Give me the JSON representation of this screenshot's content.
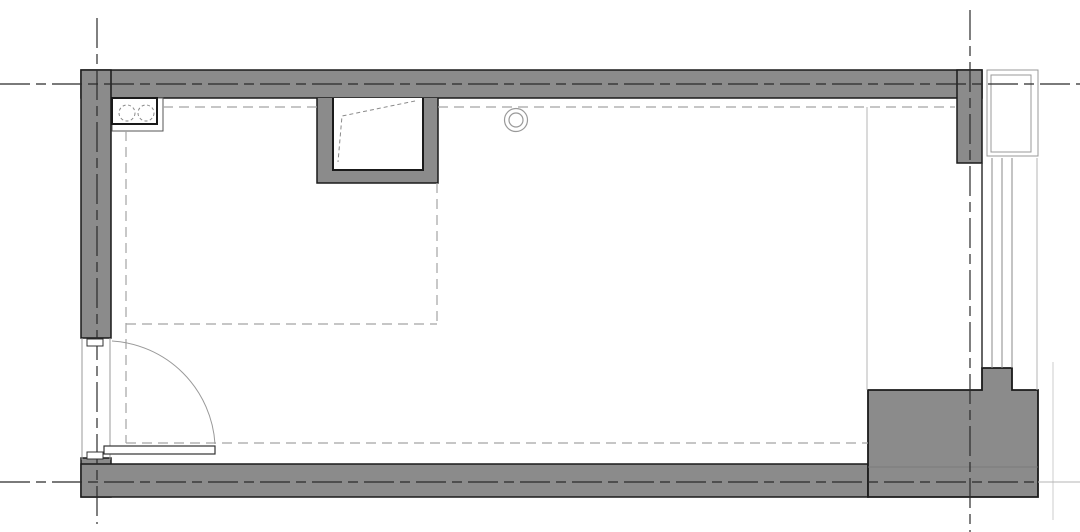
{
  "meta": {
    "description": "Architectural floor plan of a single rectangular room (CAD plan view), no text labels visible",
    "canvas": {
      "width": 1080,
      "height": 532
    }
  },
  "colors": {
    "background": "#ffffff",
    "wall_fill": "#8b8b8b",
    "wall_outline": "#1a1a1a",
    "centerline": "#2b2b2b",
    "hidden_line": "#a3a3a3",
    "light_line": "#b5b5b5",
    "faint_line": "#cccccc",
    "fixture_line": "#333333",
    "fixture_dashed": "#8a8a8a",
    "thin_gray": "#999999",
    "white": "#ffffff"
  },
  "elements": [
    {
      "name": "top-wall",
      "kind": "wall",
      "type": "rect",
      "x": 81,
      "y": 70,
      "w": 901,
      "h": 28,
      "fill": "wall_fill",
      "stroke": "wall_outline",
      "sw": 1.5
    },
    {
      "name": "left-wall",
      "kind": "wall",
      "type": "rect",
      "x": 81,
      "y": 70,
      "w": 30,
      "h": 268,
      "fill": "wall_fill",
      "stroke": "wall_outline",
      "sw": 1.5
    },
    {
      "name": "right-wall-stub",
      "kind": "wall",
      "type": "rect",
      "x": 957,
      "y": 70,
      "w": 25,
      "h": 93,
      "fill": "wall_fill",
      "stroke": "wall_outline",
      "sw": 1.5
    },
    {
      "name": "left-wall-bottom",
      "kind": "wall",
      "type": "rect",
      "x": 81,
      "y": 458,
      "w": 30,
      "h": 39,
      "fill": "wall_fill",
      "stroke": "wall_outline",
      "sw": 1.5
    },
    {
      "name": "bottom-wall",
      "kind": "wall",
      "type": "rect",
      "x": 81,
      "y": 464,
      "w": 787,
      "h": 33,
      "fill": "wall_fill",
      "stroke": "wall_outline",
      "sw": 1.5
    },
    {
      "name": "corner-pier",
      "kind": "wall",
      "type": "path",
      "d": "M868,390 L982,390 L982,368 L1012,368 L1012,390 L1038,390 L1038,497 L868,497 Z",
      "fill": "wall_fill",
      "stroke": "wall_outline",
      "sw": 1.8
    },
    {
      "name": "alcove-outer",
      "kind": "wall",
      "type": "path",
      "d": "M317,98 L317,183 L438,183 L438,98",
      "fill": "wall_fill",
      "stroke": "wall_outline",
      "sw": 1.5
    },
    {
      "name": "alcove-recess",
      "kind": "niche",
      "type": "path",
      "d": "M333,98 L333,170 L423,170 L423,98",
      "fill": "white",
      "stroke": "wall_outline",
      "sw": 2
    },
    {
      "name": "alcove-hidden-flap",
      "kind": "hidden",
      "type": "polyline",
      "pts": "415,101 342,116 338,162",
      "stroke": "fixture_dashed",
      "sw": 1,
      "dash": "4,3"
    },
    {
      "name": "pier-hidden-edge",
      "kind": "detail",
      "type": "line",
      "x1": 868,
      "y1": 467,
      "x2": 1038,
      "y2": 467,
      "stroke": "#767676",
      "sw": 0.8
    },
    {
      "name": "window-panel-outer",
      "kind": "window",
      "type": "rect",
      "x": 987,
      "y": 70,
      "w": 51,
      "h": 86,
      "fill": "white",
      "stroke": "thin_gray",
      "sw": 1
    },
    {
      "name": "window-panel-inner",
      "kind": "window",
      "type": "rect",
      "x": 991,
      "y": 75,
      "w": 40,
      "h": 77,
      "fill": "none",
      "stroke": "thin_gray",
      "sw": 1
    },
    {
      "name": "window-jamb-line",
      "kind": "window",
      "type": "line",
      "x1": 982,
      "y1": 163,
      "x2": 982,
      "y2": 368,
      "stroke": "fixture_line",
      "sw": 1.5
    },
    {
      "name": "window-glazing-1",
      "kind": "window",
      "type": "line",
      "x1": 992,
      "y1": 158,
      "x2": 992,
      "y2": 368,
      "stroke": "fixture_dashed",
      "sw": 1
    },
    {
      "name": "window-glazing-2",
      "kind": "window",
      "type": "line",
      "x1": 1002,
      "y1": 158,
      "x2": 1002,
      "y2": 368,
      "stroke": "fixture_dashed",
      "sw": 1
    },
    {
      "name": "window-glazing-3",
      "kind": "window",
      "type": "line",
      "x1": 1012,
      "y1": 158,
      "x2": 1012,
      "y2": 368,
      "stroke": "fixture_dashed",
      "sw": 1
    },
    {
      "name": "window-outer-face",
      "kind": "window",
      "type": "line",
      "x1": 1037,
      "y1": 158,
      "x2": 1037,
      "y2": 390,
      "stroke": "light_line",
      "sw": 1
    },
    {
      "name": "bay-edge-line",
      "kind": "detail",
      "type": "line",
      "x1": 867,
      "y1": 107,
      "x2": 867,
      "y2": 390,
      "stroke": "light_line",
      "sw": 1
    },
    {
      "name": "balcony-faint-line",
      "kind": "detail",
      "type": "line",
      "x1": 1053,
      "y1": 362,
      "x2": 1053,
      "y2": 520,
      "stroke": "faint_line",
      "sw": 1
    },
    {
      "name": "centerline-ext-right",
      "kind": "detail",
      "type": "line",
      "x1": 1038,
      "y1": 482,
      "x2": 1080,
      "y2": 482,
      "stroke": "light_line",
      "sw": 1
    },
    {
      "name": "counter-outline",
      "kind": "fixture",
      "type": "rect",
      "x": 112,
      "y": 98,
      "w": 51,
      "h": 33,
      "fill": "white",
      "stroke": "#555555",
      "sw": 1
    },
    {
      "name": "cooktop-box",
      "kind": "fixture",
      "type": "rect",
      "x": 112,
      "y": 98,
      "w": 45,
      "h": 26,
      "fill": "white",
      "stroke": "wall_outline",
      "sw": 2
    },
    {
      "name": "cooktop-burner-left",
      "kind": "fixture",
      "type": "circle",
      "cx": 127,
      "cy": 113,
      "r": 8,
      "fill": "none",
      "stroke": "fixture_dashed",
      "sw": 1,
      "dash": "3,2.5"
    },
    {
      "name": "cooktop-burner-right",
      "kind": "fixture",
      "type": "circle",
      "cx": 146,
      "cy": 113,
      "r": 8,
      "fill": "none",
      "stroke": "fixture_dashed",
      "sw": 1,
      "dash": "3,2.5"
    },
    {
      "name": "ceiling-pipe-outer",
      "kind": "fixture",
      "type": "circle",
      "cx": 516,
      "cy": 120,
      "r": 11.5,
      "fill": "none",
      "stroke": "thin_gray",
      "sw": 1.2
    },
    {
      "name": "ceiling-pipe-inner",
      "kind": "fixture",
      "type": "circle",
      "cx": 516,
      "cy": 120,
      "r": 7,
      "fill": "none",
      "stroke": "thin_gray",
      "sw": 1.2
    },
    {
      "name": "hidden-top-left",
      "kind": "hidden",
      "type": "line",
      "x1": 163,
      "y1": 107,
      "x2": 317,
      "y2": 107,
      "stroke": "hidden_line",
      "sw": 1.2,
      "dash": "10,6"
    },
    {
      "name": "hidden-top-right",
      "kind": "hidden",
      "type": "line",
      "x1": 438,
      "y1": 107,
      "x2": 955,
      "y2": 107,
      "stroke": "hidden_line",
      "sw": 1.2,
      "dash": "10,6"
    },
    {
      "name": "hidden-left-vert",
      "kind": "hidden",
      "type": "line",
      "x1": 126,
      "y1": 131,
      "x2": 126,
      "y2": 443,
      "stroke": "hidden_line",
      "sw": 1.2,
      "dash": "10,6"
    },
    {
      "name": "hidden-mid-horiz",
      "kind": "hidden",
      "type": "line",
      "x1": 126,
      "y1": 324,
      "x2": 437,
      "y2": 324,
      "stroke": "hidden_line",
      "sw": 1.2,
      "dash": "10,6"
    },
    {
      "name": "hidden-mid-vert",
      "kind": "hidden",
      "type": "line",
      "x1": 437,
      "y1": 183,
      "x2": 437,
      "y2": 324,
      "stroke": "hidden_line",
      "sw": 1.2,
      "dash": "10,6"
    },
    {
      "name": "hidden-bottom-horiz",
      "kind": "hidden",
      "type": "line",
      "x1": 126,
      "y1": 443,
      "x2": 868,
      "y2": 443,
      "stroke": "hidden_line",
      "sw": 1.2,
      "dash": "10,6"
    },
    {
      "name": "grid-line-horizontal-top",
      "kind": "grid",
      "type": "line",
      "x1": 0,
      "y1": 84,
      "x2": 1080,
      "y2": 84,
      "stroke": "centerline",
      "sw": 1.2,
      "dash": "30,6,10,6"
    },
    {
      "name": "grid-line-vertical-left",
      "kind": "grid",
      "type": "line",
      "x1": 97,
      "y1": 18,
      "x2": 97,
      "y2": 524,
      "stroke": "centerline",
      "sw": 1.2,
      "dash": "30,6,10,6"
    },
    {
      "name": "grid-line-vertical-right",
      "kind": "grid",
      "type": "line",
      "x1": 970,
      "y1": 10,
      "x2": 970,
      "y2": 532,
      "stroke": "centerline",
      "sw": 1.2,
      "dash": "30,6,10,6"
    },
    {
      "name": "grid-line-horizontal-bottom",
      "kind": "grid",
      "type": "line",
      "x1": 0,
      "y1": 482,
      "x2": 1038,
      "y2": 482,
      "stroke": "centerline",
      "sw": 1.2,
      "dash": "30,6,10,6"
    },
    {
      "name": "door-opening-outer-face",
      "kind": "door",
      "type": "line",
      "x1": 82,
      "y1": 338,
      "x2": 82,
      "y2": 460,
      "stroke": "thin_gray",
      "sw": 1
    },
    {
      "name": "door-opening-inner-face",
      "kind": "door",
      "type": "line",
      "x1": 110,
      "y1": 338,
      "x2": 110,
      "y2": 460,
      "stroke": "thin_gray",
      "sw": 1
    },
    {
      "name": "door-jamb-top",
      "kind": "door",
      "type": "rect",
      "x": 87,
      "y": 339,
      "w": 16,
      "h": 7,
      "fill": "white",
      "stroke": "fixture_line",
      "sw": 1
    },
    {
      "name": "door-jamb-bottom",
      "kind": "door",
      "type": "rect",
      "x": 87,
      "y": 452,
      "w": 16,
      "h": 7,
      "fill": "white",
      "stroke": "fixture_line",
      "sw": 1
    },
    {
      "name": "door-swing-arc",
      "kind": "door",
      "type": "path",
      "d": "M112,341 A110,110 0 0 1 215,444",
      "fill": "none",
      "stroke": "thin_gray",
      "sw": 1
    },
    {
      "name": "door-leaf",
      "kind": "door",
      "type": "rect",
      "x": 104,
      "y": 446,
      "w": 111,
      "h": 8,
      "fill": "white",
      "stroke": "fixture_line",
      "sw": 1.2
    }
  ]
}
